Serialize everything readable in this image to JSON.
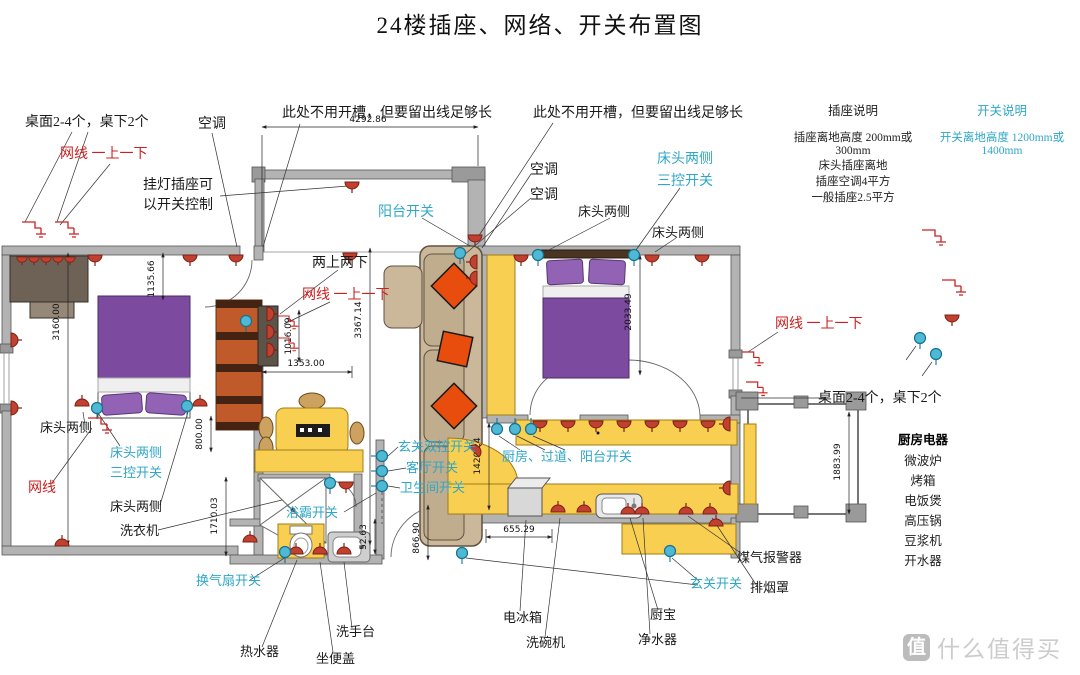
{
  "title": "24楼插座、网络、开关布置图",
  "legend": {
    "socket_title": "插座说明",
    "socket_line1": "插座离地高度  200mm或300mm",
    "socket_line2": "床头插座离地",
    "socket_line3": "插座空调4平方",
    "socket_line4": "一般插座2.5平方",
    "switch_title": "开关说明",
    "switch_line": "开关离地高度  1200mm或1400mm"
  },
  "labels": {
    "desk_note_left": "桌面2-4个，桌下2个",
    "net_top_left": "网线 一上一下",
    "ac_left": "空调",
    "lamp_line1": "挂灯插座可",
    "lamp_line2": "以开关控制",
    "slot_note_1": "此处不用开槽，但要留出线足够长",
    "slot_note_2": "此处不用开槽，但要留出线足够长",
    "ac_mid_1": "空调",
    "ac_mid_2": "空调",
    "balcony_switch": "阳台开关",
    "bed2_sides_cyan": "床头两侧",
    "bed2_3ctl": "三控开关",
    "bed2_side_a": "床头两侧",
    "bed2_side_b": "床头两侧",
    "two_up_two_down": "两上两下",
    "net_mid": "网线  一上一下",
    "net_right": "网线  一上一下",
    "desk_note_right": "桌面2-4个，桌下2个",
    "kitchen_appliances_title": "厨房电器",
    "bed1_side_a": "床头两侧",
    "bed1_sides_cyan": "床头两侧",
    "bed1_3ctl": "三控开关",
    "net_left": "网线",
    "bed1_side_b": "床头两侧",
    "washing_machine": "洗衣机",
    "fan_switch": "换气扇开关",
    "entry_dual_switch": "玄关双控开关",
    "living_switch": "客厅开关",
    "bathroom_switch": "卫生间开关",
    "bath_heater_switch": "浴霸开关",
    "kitchen_corridor_balcony_switch": "厨房、过道、阳台开关",
    "entry_switch": "玄关开关",
    "water_heater": "热水器",
    "toilet_lid": "坐便盖",
    "wash_basin": "洗手台",
    "fridge": "电冰箱",
    "dishwasher": "洗碗机",
    "kitchen_water_heater": "厨宝",
    "water_purifier": "净水器",
    "gas_alarm": "煤气报警器",
    "range_hood": "排烟罩"
  },
  "appliances": [
    "微波炉",
    "烤箱",
    "电饭煲",
    "高压锅",
    "豆浆机",
    "开水器"
  ],
  "dims": {
    "balcony_width": "4292.86",
    "bed1_offset": "1135.66",
    "bedroom1_width": "3160.00",
    "tv_wall": "1016.09",
    "table_width": "1353.00",
    "living_depth": "3367.14",
    "gap_800": "800.00",
    "bathroom_depth": "1710.03",
    "bed2_length": "2033.49",
    "corridor": "1420.24",
    "wall_gap": "52.63",
    "entry_door": "866.90",
    "counter_offset": "655.29",
    "balcony2_height": "1883.99"
  },
  "watermark": {
    "badge": "值",
    "brand": "什么值得买"
  },
  "colors": {
    "wall": "#b3b3b3",
    "socket_red": "#c2402f",
    "network_cyan": "#4fb8d4",
    "label_cyan": "#2fa7c7",
    "label_red": "#cc2020",
    "furniture_yellow": "#f9cf52",
    "bed_purple": "#7c4a9e",
    "wardrobe_orange": "#c05a2a",
    "sofa_tan": "#cbb89a"
  }
}
